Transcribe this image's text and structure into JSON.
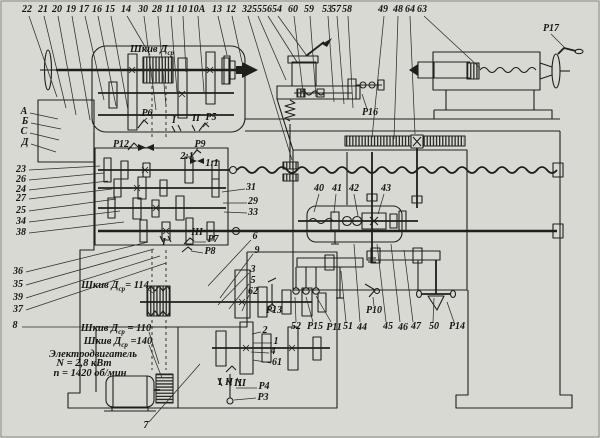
{
  "colors": {
    "paper": "#d9d9d3",
    "ink": "#1e1e1c"
  },
  "labels": [
    {
      "t": "22",
      "x": 27,
      "y": 10,
      "lead": [
        29,
        16,
        57,
        97
      ]
    },
    {
      "t": "21",
      "x": 43,
      "y": 10,
      "lead": [
        44,
        16,
        66,
        108
      ]
    },
    {
      "t": "20",
      "x": 57,
      "y": 10,
      "lead": [
        58,
        16,
        76,
        115
      ]
    },
    {
      "t": "19",
      "x": 71,
      "y": 10,
      "lead": [
        72,
        16,
        90,
        120
      ]
    },
    {
      "t": "17",
      "x": 84,
      "y": 10,
      "lead": [
        85,
        16,
        104,
        100
      ]
    },
    {
      "t": "16",
      "x": 97,
      "y": 10,
      "lead": [
        98,
        16,
        116,
        106
      ]
    },
    {
      "t": "15",
      "x": 110,
      "y": 10,
      "lead": [
        111,
        16,
        128,
        110
      ]
    },
    {
      "t": "14",
      "x": 126,
      "y": 10,
      "lead": [
        127,
        16,
        150,
        55
      ]
    },
    {
      "t": "30",
      "x": 143,
      "y": 10,
      "lead": [
        144,
        16,
        156,
        110
      ]
    },
    {
      "t": "28",
      "x": 157,
      "y": 10,
      "lead": [
        158,
        16,
        166,
        106
      ]
    },
    {
      "t": "11",
      "x": 170,
      "y": 10,
      "lead": [
        171,
        16,
        177,
        92
      ]
    },
    {
      "t": "10",
      "x": 182,
      "y": 10,
      "lead": [
        183,
        16,
        186,
        72
      ]
    },
    {
      "t": "10А",
      "x": 197,
      "y": 10,
      "lead": [
        198,
        16,
        204,
        92
      ]
    },
    {
      "t": "13",
      "x": 217,
      "y": 10,
      "lead": [
        218,
        16,
        227,
        55
      ]
    },
    {
      "t": "12",
      "x": 231,
      "y": 10,
      "lead": [
        232,
        16,
        242,
        62
      ]
    },
    {
      "t": "32",
      "x": 247,
      "y": 10,
      "lead": [
        248,
        16,
        292,
        160
      ]
    },
    {
      "t": "55",
      "x": 257,
      "y": 10,
      "lead": [
        258,
        16,
        286,
        80
      ]
    },
    {
      "t": "56",
      "x": 267,
      "y": 10,
      "lead": [
        268,
        16,
        297,
        62
      ]
    },
    {
      "t": "54",
      "x": 277,
      "y": 10,
      "lead": [
        278,
        16,
        307,
        56
      ]
    },
    {
      "t": "60",
      "x": 293,
      "y": 10,
      "lead": [
        294,
        16,
        303,
        92
      ]
    },
    {
      "t": "59",
      "x": 309,
      "y": 10,
      "lead": [
        310,
        16,
        316,
        97
      ]
    },
    {
      "t": "53",
      "x": 327,
      "y": 10,
      "lead": [
        328,
        16,
        334,
        102
      ]
    },
    {
      "t": "57",
      "x": 336,
      "y": 10,
      "lead": [
        337,
        16,
        344,
        104
      ]
    },
    {
      "t": "58",
      "x": 347,
      "y": 10,
      "lead": [
        348,
        16,
        353,
        108
      ]
    },
    {
      "t": "49",
      "x": 383,
      "y": 10,
      "lead": [
        384,
        16,
        372,
        138
      ]
    },
    {
      "t": "48",
      "x": 398,
      "y": 10,
      "lead": [
        398,
        16,
        394,
        139
      ]
    },
    {
      "t": "64",
      "x": 410,
      "y": 10,
      "lead": [
        410,
        16,
        415,
        134
      ]
    },
    {
      "t": "63",
      "x": 422,
      "y": 10,
      "lead": [
        424,
        16,
        480,
        68
      ]
    },
    {
      "t": "Р17",
      "x": 551,
      "y": 29,
      "lead": [
        551,
        34,
        566,
        49
      ]
    },
    {
      "t": "А",
      "x": 24,
      "y": 112,
      "lead": [
        30,
        113,
        58,
        119
      ]
    },
    {
      "t": "Б",
      "x": 25,
      "y": 122,
      "lead": [
        31,
        123,
        61,
        129
      ]
    },
    {
      "t": "С",
      "x": 24,
      "y": 132,
      "lead": [
        30,
        133,
        59,
        140
      ]
    },
    {
      "t": "Д",
      "x": 25,
      "y": 143,
      "lead": [
        31,
        144,
        56,
        152
      ]
    },
    {
      "t": "23",
      "x": 21,
      "y": 170,
      "lead": [
        29,
        170,
        100,
        166
      ]
    },
    {
      "t": "26",
      "x": 21,
      "y": 180,
      "lead": [
        29,
        180,
        104,
        173
      ]
    },
    {
      "t": "24",
      "x": 21,
      "y": 190,
      "lead": [
        29,
        190,
        108,
        181
      ]
    },
    {
      "t": "27",
      "x": 21,
      "y": 199,
      "lead": [
        29,
        199,
        112,
        189
      ]
    },
    {
      "t": "25",
      "x": 21,
      "y": 211,
      "lead": [
        29,
        211,
        116,
        199
      ]
    },
    {
      "t": "34",
      "x": 21,
      "y": 222,
      "lead": [
        29,
        222,
        120,
        211
      ]
    },
    {
      "t": "38",
      "x": 21,
      "y": 233,
      "lead": [
        29,
        233,
        124,
        222
      ]
    },
    {
      "t": "36",
      "x": 18,
      "y": 272,
      "lead": [
        26,
        272,
        148,
        242
      ]
    },
    {
      "t": "35",
      "x": 18,
      "y": 285,
      "lead": [
        26,
        285,
        154,
        249
      ]
    },
    {
      "t": "39",
      "x": 18,
      "y": 298,
      "lead": [
        26,
        298,
        160,
        256
      ]
    },
    {
      "t": "37",
      "x": 18,
      "y": 310,
      "lead": [
        26,
        310,
        166,
        263
      ]
    },
    {
      "t": "8",
      "x": 15,
      "y": 326,
      "lead": [
        22,
        327,
        240,
        327
      ]
    },
    {
      "t": "Р6",
      "x": 147,
      "y": 114,
      "lead": [
        147,
        118,
        141,
        124
      ]
    },
    {
      "t": "I",
      "x": 174,
      "y": 121
    },
    {
      "t": "II",
      "x": 196,
      "y": 119
    },
    {
      "t": "Р5",
      "x": 211,
      "y": 118,
      "lead": [
        208,
        122,
        203,
        127
      ]
    },
    {
      "t": "Р12",
      "x": 121,
      "y": 145,
      "lead": [
        129,
        147,
        133,
        148
      ]
    },
    {
      "t": "Р9",
      "x": 200,
      "y": 145,
      "lead": [
        198,
        148,
        195,
        152
      ]
    },
    {
      "t": "2:1",
      "x": 187,
      "y": 157
    },
    {
      "t": "1:1",
      "x": 212,
      "y": 164
    },
    {
      "t": "31",
      "x": 251,
      "y": 188,
      "lead": [
        245,
        189,
        222,
        192
      ]
    },
    {
      "t": "29",
      "x": 253,
      "y": 202,
      "lead": [
        247,
        203,
        223,
        203
      ]
    },
    {
      "t": "33",
      "x": 253,
      "y": 213,
      "lead": [
        247,
        213,
        224,
        212
      ]
    },
    {
      "t": "6",
      "x": 255,
      "y": 237,
      "lead": [
        251,
        240,
        208,
        286
      ]
    },
    {
      "t": "9",
      "x": 257,
      "y": 251,
      "lead": [
        253,
        254,
        220,
        298
      ]
    },
    {
      "t": "3",
      "x": 253,
      "y": 270,
      "lead": [
        249,
        273,
        218,
        305
      ]
    },
    {
      "t": "5",
      "x": 253,
      "y": 281,
      "lead": [
        249,
        284,
        229,
        309
      ]
    },
    {
      "t": "62",
      "x": 253,
      "y": 292,
      "lead": [
        249,
        295,
        242,
        311
      ]
    },
    {
      "t": "Р7",
      "x": 213,
      "y": 240,
      "lead": [
        206,
        242,
        194,
        242
      ]
    },
    {
      "t": "Р8",
      "x": 210,
      "y": 252,
      "lead": [
        203,
        253,
        191,
        251
      ]
    },
    {
      "t": "III",
      "x": 197,
      "y": 233
    },
    {
      "t": "I",
      "x": 164,
      "y": 243
    },
    {
      "t": "40",
      "x": 319,
      "y": 189,
      "lead": [
        319,
        194,
        314,
        212
      ]
    },
    {
      "t": "41",
      "x": 337,
      "y": 189,
      "lead": [
        336,
        194,
        334,
        213
      ]
    },
    {
      "t": "42",
      "x": 354,
      "y": 189,
      "lead": [
        354,
        194,
        358,
        216
      ]
    },
    {
      "t": "43",
      "x": 386,
      "y": 189,
      "lead": [
        384,
        194,
        378,
        214
      ]
    },
    {
      "t": "Р16",
      "x": 370,
      "y": 113,
      "lead": [
        367,
        109,
        362,
        94
      ]
    },
    {
      "t": "Р13",
      "x": 274,
      "y": 311,
      "lead": [
        273,
        306,
        272,
        299
      ]
    },
    {
      "t": "52",
      "x": 296,
      "y": 327,
      "lead": [
        296,
        322,
        295,
        297
      ]
    },
    {
      "t": "Р15",
      "x": 315,
      "y": 327,
      "lead": [
        313,
        322,
        306,
        297
      ]
    },
    {
      "t": "Р11",
      "x": 334,
      "y": 328,
      "lead": [
        331,
        322,
        316,
        296
      ]
    },
    {
      "t": "51",
      "x": 348,
      "y": 327,
      "lead": [
        346,
        322,
        341,
        271
      ]
    },
    {
      "t": "44",
      "x": 362,
      "y": 328,
      "lead": [
        360,
        322,
        354,
        244
      ]
    },
    {
      "t": "Р10",
      "x": 374,
      "y": 311,
      "lead": [
        374,
        306,
        373,
        297
      ]
    },
    {
      "t": "45",
      "x": 388,
      "y": 327,
      "lead": [
        386,
        322,
        377,
        244
      ]
    },
    {
      "t": "46",
      "x": 403,
      "y": 328,
      "lead": [
        400,
        322,
        391,
        244
      ]
    },
    {
      "t": "47",
      "x": 416,
      "y": 327,
      "lead": [
        413,
        322,
        404,
        250
      ]
    },
    {
      "t": "50",
      "x": 434,
      "y": 327,
      "lead": [
        433,
        322,
        434,
        298
      ]
    },
    {
      "t": "Р14",
      "x": 457,
      "y": 327,
      "lead": [
        454,
        322,
        447,
        302
      ]
    },
    {
      "t": "2",
      "x": 265,
      "y": 331,
      "lead": [
        261,
        332,
        252,
        334
      ]
    },
    {
      "t": "1",
      "x": 276,
      "y": 342,
      "lead": [
        272,
        343,
        253,
        343
      ]
    },
    {
      "t": "4",
      "x": 273,
      "y": 352,
      "lead": [
        269,
        353,
        251,
        352
      ]
    },
    {
      "t": "61",
      "x": 277,
      "y": 363,
      "lead": [
        271,
        363,
        253,
        360
      ]
    },
    {
      "t": "Р4",
      "x": 264,
      "y": 387,
      "lead": [
        257,
        388,
        236,
        388
      ]
    },
    {
      "t": "Р3",
      "x": 263,
      "y": 398,
      "lead": [
        256,
        398,
        234,
        400
      ]
    },
    {
      "t": "7",
      "x": 146,
      "y": 426,
      "lead": [
        149,
        422,
        200,
        364
      ]
    },
    {
      "t": "I",
      "x": 220,
      "y": 383
    },
    {
      "t": "II",
      "x": 229,
      "y": 383
    },
    {
      "t": "III",
      "x": 240,
      "y": 384
    }
  ],
  "notes": [
    {
      "pre": "Шкив Д",
      "sub": "ср",
      "post": "",
      "x": 152,
      "y": 51
    },
    {
      "pre": "Шкив Д",
      "sub": "ср",
      "post": "= 114",
      "x": 115,
      "y": 287,
      "lead": [
        147,
        289,
        153,
        293
      ]
    },
    {
      "pre": "Шкив Д",
      "sub": "ср",
      "post": " = 110",
      "x": 116,
      "y": 330,
      "lead": [
        149,
        332,
        159,
        364
      ]
    },
    {
      "pre": "Шкив Д",
      "sub": "ср",
      "post": " =140",
      "x": 118,
      "y": 343,
      "lead": [
        149,
        345,
        162,
        378
      ]
    },
    {
      "t": "Электродвигатель",
      "x": 93,
      "y": 355
    },
    {
      "t": "N = 2,8 кВт",
      "x": 84,
      "y": 364
    },
    {
      "t": "n = 1420 об/мин",
      "x": 90,
      "y": 374
    }
  ]
}
